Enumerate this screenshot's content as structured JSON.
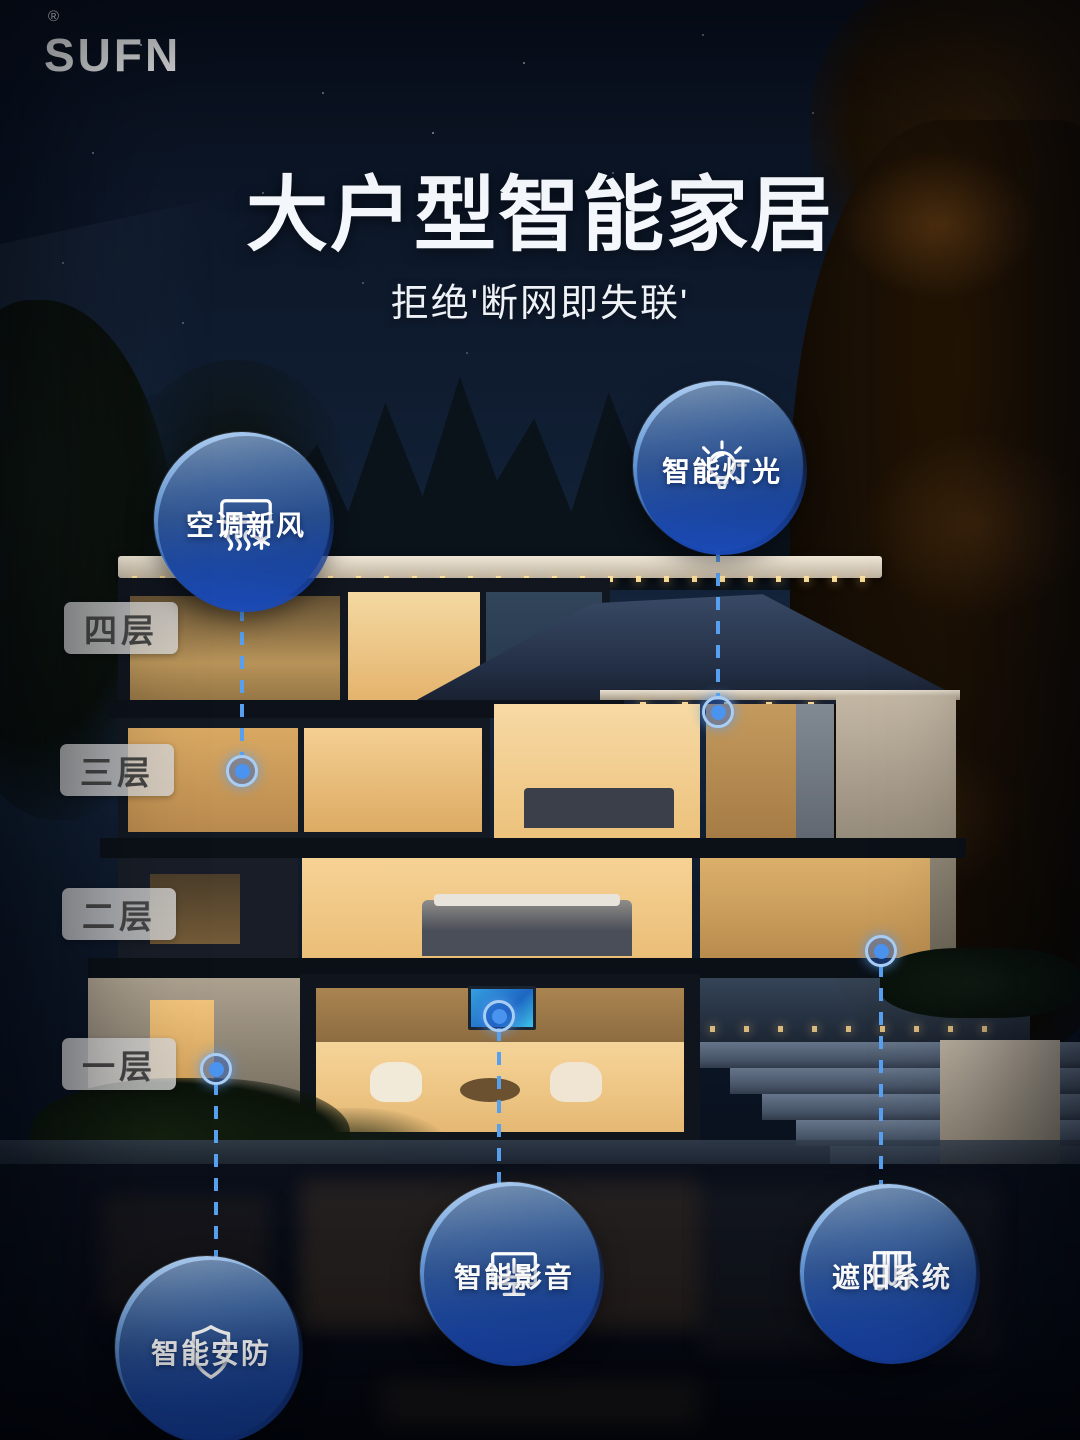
{
  "brand": {
    "name": "SUFN",
    "registered": "®"
  },
  "header": {
    "title": "大户型智能家居",
    "subtitle": "拒绝'断网即失联'"
  },
  "floors": [
    {
      "label": "四层"
    },
    {
      "label": "三层"
    },
    {
      "label": "二层"
    },
    {
      "label": "一层"
    }
  ],
  "callouts": [
    {
      "id": "hvac",
      "label": "空调新风",
      "icon": "air-conditioner-icon"
    },
    {
      "id": "lighting",
      "label": "智能灯光",
      "icon": "lightbulb-icon"
    },
    {
      "id": "security",
      "label": "智能安防",
      "icon": "shield-icon"
    },
    {
      "id": "av",
      "label": "智能影音",
      "icon": "monitor-icon"
    },
    {
      "id": "shading",
      "label": "遮阳系统",
      "icon": "curtain-icon"
    }
  ],
  "colors": {
    "accent_blue": "#57a0f0",
    "circle_fill_deep": "#1a4bbc",
    "pill_bg": "#d6d6d6",
    "pill_text": "#454545",
    "warm_window": "#f4cf92",
    "sky": "#15263e"
  }
}
